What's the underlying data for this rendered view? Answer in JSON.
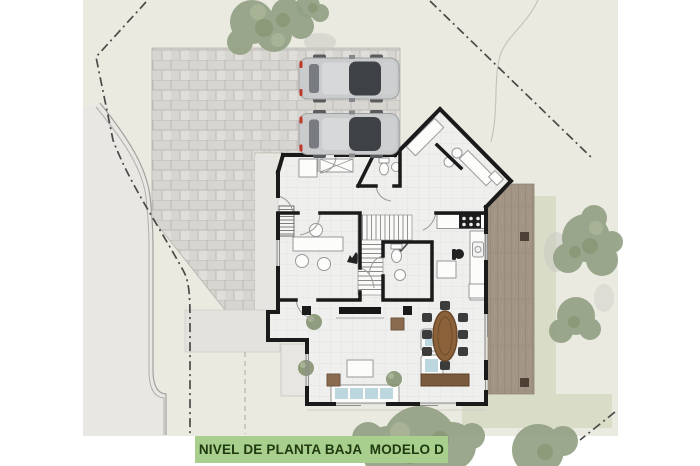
{
  "label": {
    "text": "NIVEL DE PLANTA BAJA  MODELO D"
  },
  "colors": {
    "page": "#ffffff",
    "site": "#EBEAE1",
    "road": "#E9E7E4",
    "curb": "#A3A19E",
    "brick": "#D7D5D0",
    "brick_mortar": "#BFBCB7",
    "path": "#E7E5E1",
    "apron": "#E4E2DD",
    "boundary": "#4A4A48",
    "contour": "#C2C1BA",
    "floor": "#EFEFED",
    "floor_grid": "#E3E3E1",
    "wall": "#1A1A1A",
    "fixture_stroke": "#98989A",
    "fixture_fill": "#FCFCFB",
    "deck": "#A29585",
    "deck_stripe": "#8D8173",
    "deck_post": "#4C4134",
    "lawn": "#D9DCC7",
    "tree": "#93A184",
    "tree_dark": "#7E8D68",
    "tree_light": "#A8B394",
    "shadow": "#C8C8C2",
    "car_body": "#C9CBCC",
    "car_glass": "#3E4247",
    "car_detail": "#9EA0A2",
    "tail_light": "#C0392B",
    "wood": "#8A6138",
    "wood_dark": "#6B4A2B",
    "sideboard": "#7A5B3E",
    "pouf": "#8A6B4F",
    "sofa_pillow": "#BCD7DF",
    "label_bg": "#A8CF8E",
    "label_text": "#203A10"
  }
}
